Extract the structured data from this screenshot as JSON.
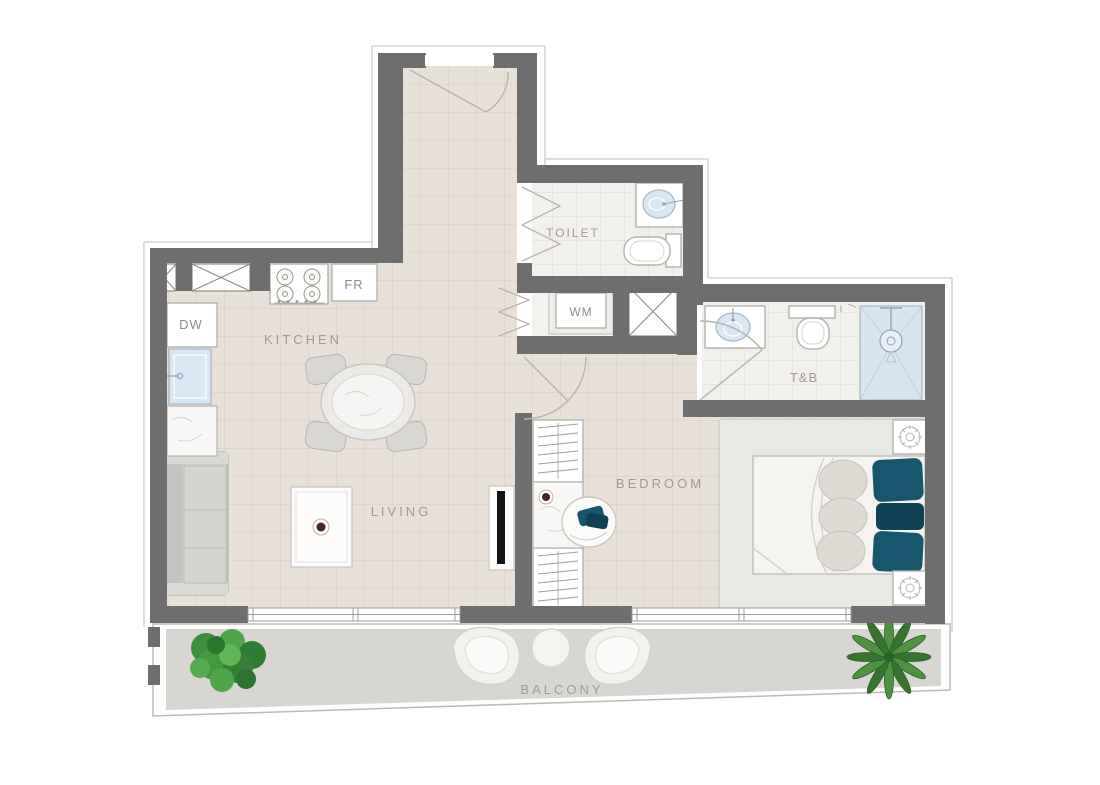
{
  "rooms": {
    "kitchen": "KITCHEN",
    "living": "LIVING",
    "bedroom": "BEDROOM",
    "toilet": "TOILET",
    "toilet_bath": "T&B",
    "balcony": "BALCONY"
  },
  "appliances": {
    "dishwasher": "DW",
    "fridge": "FR",
    "washing_machine": "WM"
  },
  "colors": {
    "wall": "#6e6e6e",
    "floor_main": "#e8e1da",
    "grid_main": "#d7ccc3",
    "floor_bath": "#f2f0ec",
    "grid_bath": "#ddd9d4",
    "floor_balcony": "#d8d6d2",
    "shower": "#d8e5f1",
    "sink": "#d9e6f4",
    "teal": "#17566c",
    "teal_dark": "#0f4254",
    "label": "#a29b93",
    "label_dark": "#8f8c86",
    "fixture_stroke": "#b5b2ac"
  }
}
